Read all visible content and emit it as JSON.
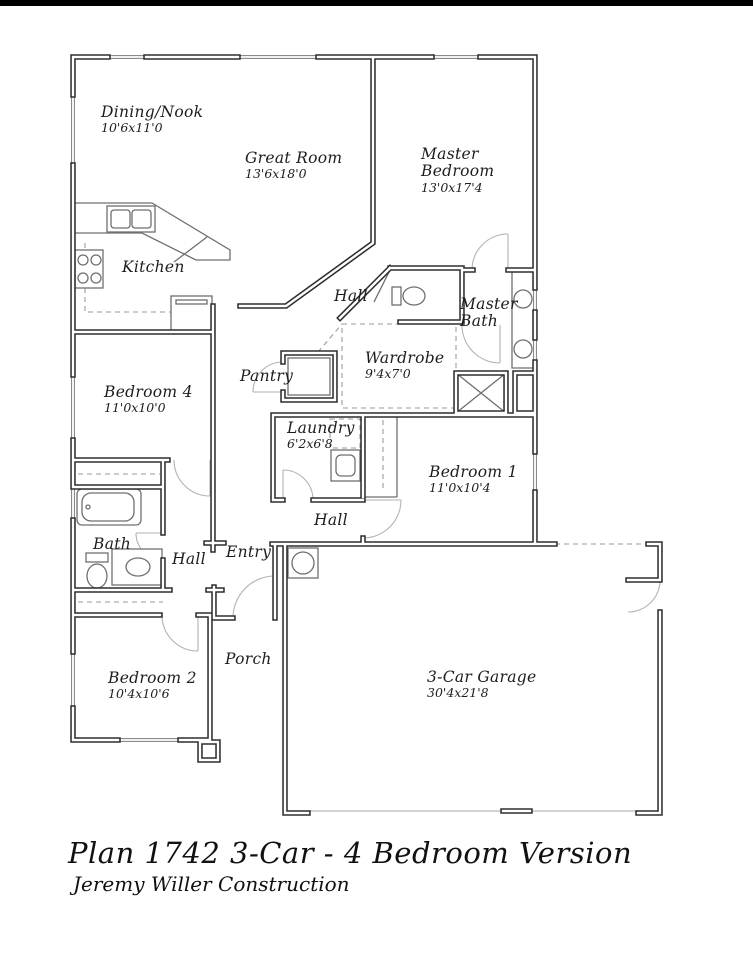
{
  "footer": {
    "title": "Plan 1742 3-Car - 4 Bedroom Version",
    "subtitle": "Jeremy Willer Construction"
  },
  "colors": {
    "wall": "#2e2e2e",
    "thin_line": "#6f6f6f",
    "dashed_line": "#9a9a9a",
    "door_arc": "#b2b2b2",
    "top_bar": "#000000",
    "background": "#ffffff"
  },
  "rooms": {
    "dining": {
      "name": "Dining/Nook",
      "dims": "10'6x11'0"
    },
    "great_room": {
      "name": "Great Room",
      "dims": "13'6x18'0"
    },
    "master_bedroom": {
      "name": "Master Bedroom",
      "dims": "13'0x17'4"
    },
    "kitchen": {
      "name": "Kitchen"
    },
    "hall_upper": {
      "name": "Hall"
    },
    "master_bath": {
      "name": "Master Bath"
    },
    "wardrobe": {
      "name": "Wardrobe",
      "dims": "9'4x7'0"
    },
    "pantry": {
      "name": "Pantry"
    },
    "bedroom4": {
      "name": "Bedroom 4",
      "dims": "11'0x10'0"
    },
    "laundry": {
      "name": "Laundry",
      "dims": "6'2x6'8"
    },
    "bedroom1": {
      "name": "Bedroom 1",
      "dims": "11'0x10'4"
    },
    "bath": {
      "name": "Bath"
    },
    "hall_middle": {
      "name": "Hall"
    },
    "entry": {
      "name": "Entry"
    },
    "hall_lower": {
      "name": "Hall"
    },
    "bedroom2": {
      "name": "Bedroom 2",
      "dims": "10'4x10'6"
    },
    "porch": {
      "name": "Porch"
    },
    "garage": {
      "name": "3-Car Garage",
      "dims": "30'4x21'8"
    }
  }
}
